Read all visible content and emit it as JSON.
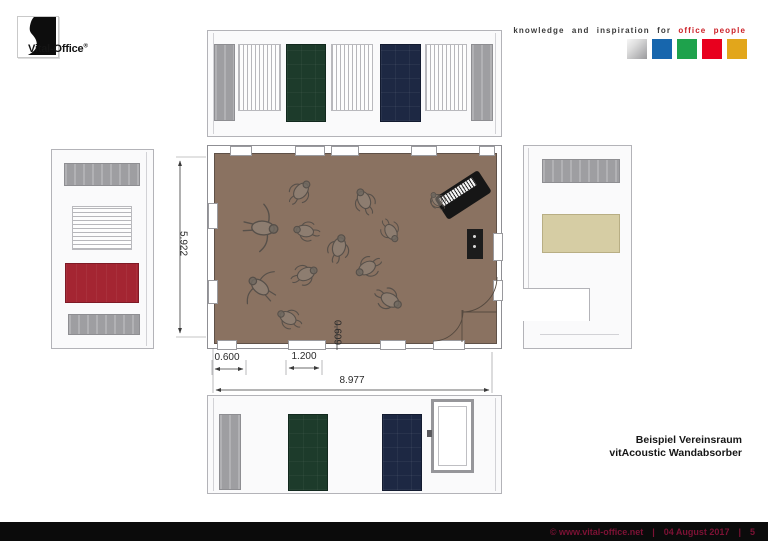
{
  "logo": {
    "brand": "Vital-Office",
    "registered_mark": "®"
  },
  "tagline": {
    "prefix": "knowledge and inspiration for",
    "highlight": "office people"
  },
  "swatches": {
    "silver": "#c0c0c2",
    "blue": "#1766ad",
    "green": "#1ea24c",
    "red": "#e8001e",
    "gold": "#e2a61b"
  },
  "drawing": {
    "dim_total_width": "8.977",
    "dim_panel_offset": "0.600",
    "dim_panel_width": "1.200",
    "dim_room_depth": "5.922",
    "dim_door_offset": "0.609"
  },
  "title_block": {
    "line1": "Beispiel Vereinsraum",
    "line2": "vitAcoustic Wandabsorber"
  },
  "footer": {
    "copyright": "©  www.vital-office.net",
    "sep1": "|",
    "date": "04 August 2017",
    "sep2": "|",
    "page": "5"
  },
  "colors": {
    "floor": "#8a7261",
    "panel_green": "#1d3b2b",
    "panel_navy": "#1d2843",
    "panel_red": "#a42532",
    "panel_beige": "#d6cda4",
    "panel_gray": "#a6a6aa",
    "accent_red": "#cc2027",
    "footer_text": "#7d1235",
    "footer_bar": "#0b0b0b"
  }
}
